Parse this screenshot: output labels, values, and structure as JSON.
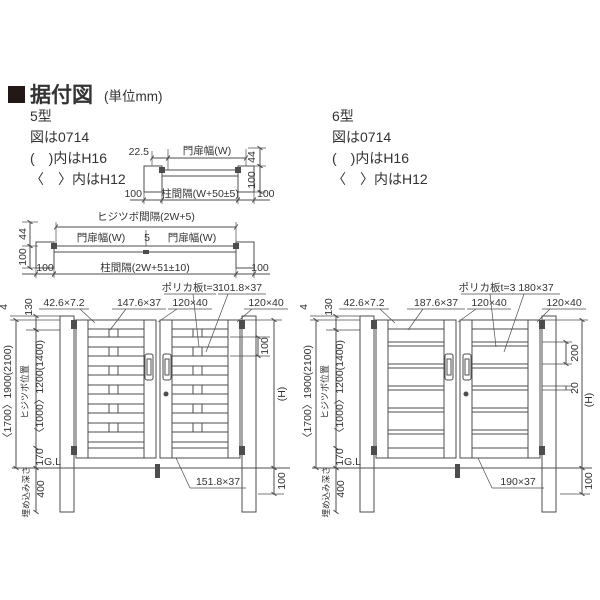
{
  "colors": {
    "ink": "#333333",
    "line": "#4d4d4d",
    "accent": "#231815",
    "bg": "#ffffff",
    "frame": "#e9e9e9"
  },
  "header": {
    "title": "据付図",
    "unit": "(単位mm)"
  },
  "panel5": {
    "model": "5型",
    "fig": "図は0714",
    "h16": "(　)内はH16",
    "h12": "〈　〉内はH12"
  },
  "panel6": {
    "model": "6型",
    "fig": "図は0714",
    "h16": "(　)内はH16",
    "h12": "〈　〉内はH12"
  },
  "plan1": {
    "offset": "22.5",
    "leaf": "門扉幅(W)",
    "d44": "44",
    "d100v": "100",
    "dl": "100",
    "span": "柱間隔(W+50±5)",
    "dr": "100"
  },
  "plan2": {
    "hinge_span": "ヒジツボ間隔(2W+5)",
    "leafL": "門扉幅(W)",
    "gap": "5",
    "leafR": "門扉幅(W)",
    "d44": "44",
    "d100v": "100",
    "dl": "100",
    "span": "柱間隔(2W+51±10)",
    "dr": "100"
  },
  "elev5": {
    "d4": "4",
    "d130": "130",
    "cap": "42.6×7.2",
    "slat": "147.6×37",
    "frame1": "120×40",
    "poly": "ポリカ板t=3",
    "topslat": "101.8×37",
    "frame2": "120×40",
    "pitch": "100",
    "H": "(H)",
    "total": "〈1700〉1900(2100)",
    "hingeLabel": "ヒジツボ位置",
    "hingePos": "〈1000〉1200(1400)",
    "clear": "170",
    "gl": "G.L",
    "embedLabel": "埋め込み深さ",
    "embed": "400",
    "bottom": "151.8×37",
    "below": "100"
  },
  "elev6": {
    "d4": "4",
    "d130": "130",
    "cap": "42.6×7.2",
    "slat": "187.6×37",
    "frame1": "120×40",
    "poly": "ポリカ板t=3",
    "topslat": "180×37",
    "frame2": "120×40",
    "pitch": "200",
    "railH": "20",
    "H": "(H)",
    "total": "〈1700〉1900(2100)",
    "hingeLabel": "ヒジツボ位置",
    "hingePos": "〈1000〉1200(1400)",
    "clear": "170",
    "gl": "G.L",
    "embedLabel": "埋め込み深さ",
    "embed": "400",
    "bottom": "190×37",
    "below": "100"
  }
}
